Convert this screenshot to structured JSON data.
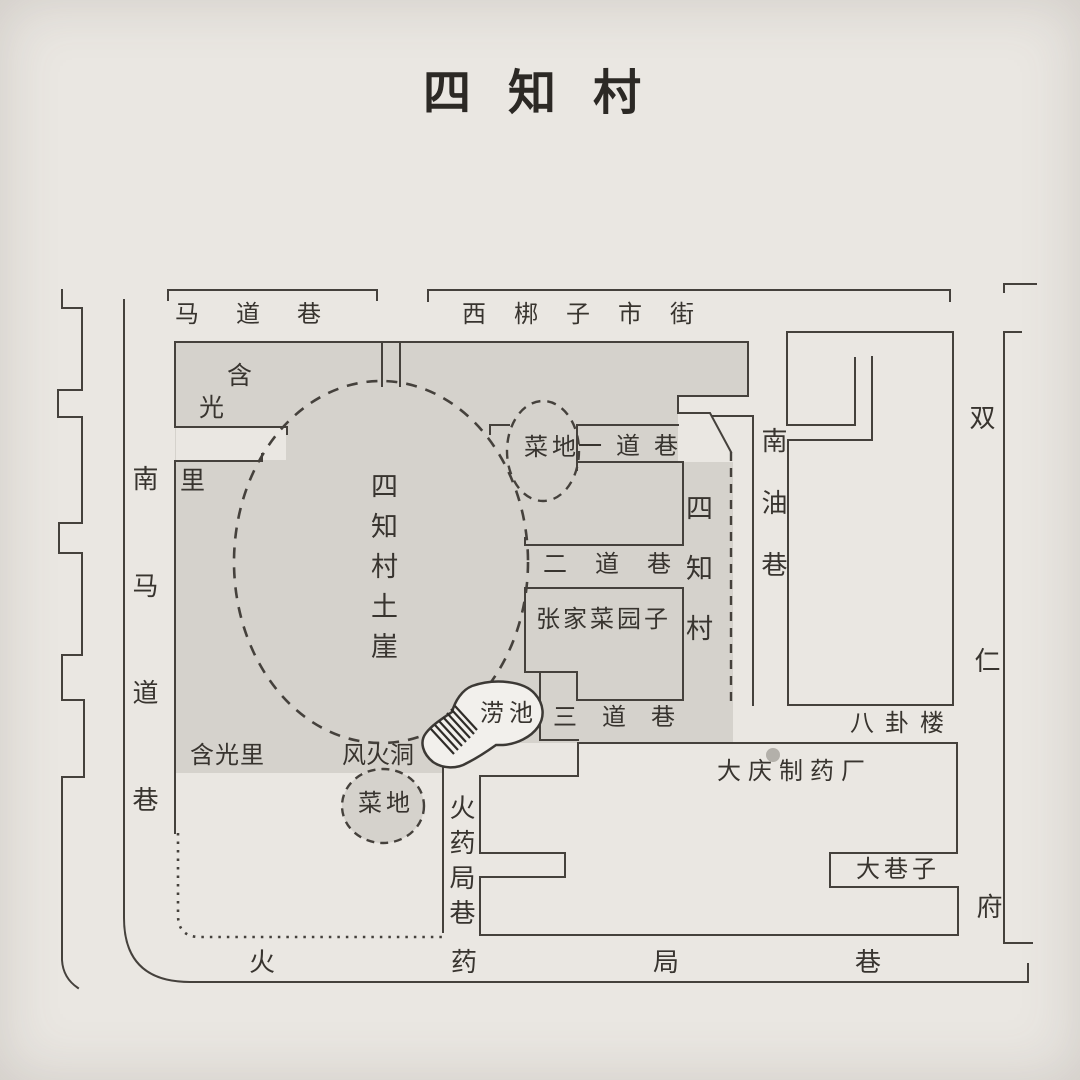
{
  "title": "四知村",
  "streets": {
    "madaoxiang": "马道巷",
    "xibangzi_shijie": "西梆子市街",
    "nan_ma_dao_xiang": "南马道巷",
    "hanguang_char1": "含",
    "hanguang_char2": "光",
    "hanguang_char3": "里",
    "hanguangli": "含光里",
    "yidaoxiang": "一道巷",
    "erdaoxiang": "二道巷",
    "sandaoxiang": "三道巷",
    "nanyouxiang": "南油巷",
    "huoyaojuxiang_vertical": "火药局巷",
    "huoyaojuxiang_bottom": "火药局巷",
    "daxiangzi": "大巷子",
    "shuangrenfu": [
      "双",
      "仁",
      "府"
    ]
  },
  "places": {
    "sizhicun_tuya": "四知村土崖",
    "sizhicun": "四知村",
    "caidi_top": "菜地",
    "caidi_bottom": "菜地",
    "zhangjia_caiyuanzi": "张家菜园子",
    "laochi": "涝池",
    "fenghuodong": "风火洞",
    "bagualou": "八卦楼",
    "daqing_zhiyaochang": "大庆制药厂"
  },
  "colors": {
    "paper": "#eae7e2",
    "village_gray": "#d5d2cc",
    "line": "#45413c",
    "pond_fill": "#f2f0ec",
    "factory_dot": "#b3b0aa"
  }
}
